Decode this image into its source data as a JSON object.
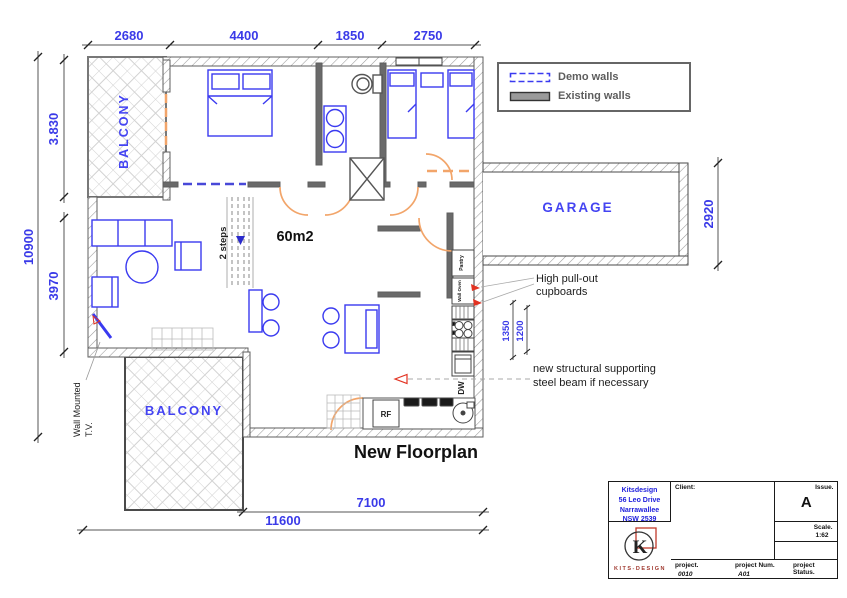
{
  "plan_title": "New Floorplan",
  "dimensions": {
    "top": [
      "2680",
      "4400",
      "1850",
      "2750"
    ],
    "left_total": "10900",
    "left_upper": "3.830",
    "left_lower": "3970",
    "right_garage": "2920",
    "bottom_inner": "7100",
    "bottom_total": "11600",
    "kitchen_a": "1350",
    "kitchen_b": "1200"
  },
  "rooms": {
    "balcony_top": "BALCONY",
    "balcony_bottom": "BALCONY",
    "garage": "GARAGE",
    "area": "60m2",
    "steps": "2 steps"
  },
  "fixtures": {
    "dw": "DW",
    "rf": "RF",
    "pantry": "Pantry",
    "wall_oven": "Wall Oven"
  },
  "annotations": {
    "cupboards_1": "High pull-out",
    "cupboards_2": "cupboards",
    "beam_1": "new structural supporting",
    "beam_2": "steel beam if necessary",
    "tv_1": "Wall Mounted",
    "tv_2": "T.V."
  },
  "legend": {
    "demo": "Demo walls",
    "existing": "Existing walls"
  },
  "title_block": {
    "company": [
      "Kitsdesign",
      "56 Leo Drive",
      "Narrawallee",
      "NSW 2539"
    ],
    "client_label": "Client:",
    "issue_label": "Issue.",
    "issue_value": "A",
    "scale_label": "Scale.",
    "scale_value": "1:62",
    "project_label": "project.",
    "project_value": "0010",
    "project_num_label": "project Num.",
    "project_num_value": "A01",
    "project_status_label": "project Status.",
    "logo": "KITS-DESIGN",
    "logo_letter": "K"
  },
  "colors": {
    "demo_wall": "#3a3af0",
    "existing_wall": "#5f5f5f",
    "door": "#f2a56a",
    "furniture": "#3a3af0",
    "dimension_text": "#3a3ae8",
    "arrow_red": "#e23322"
  }
}
